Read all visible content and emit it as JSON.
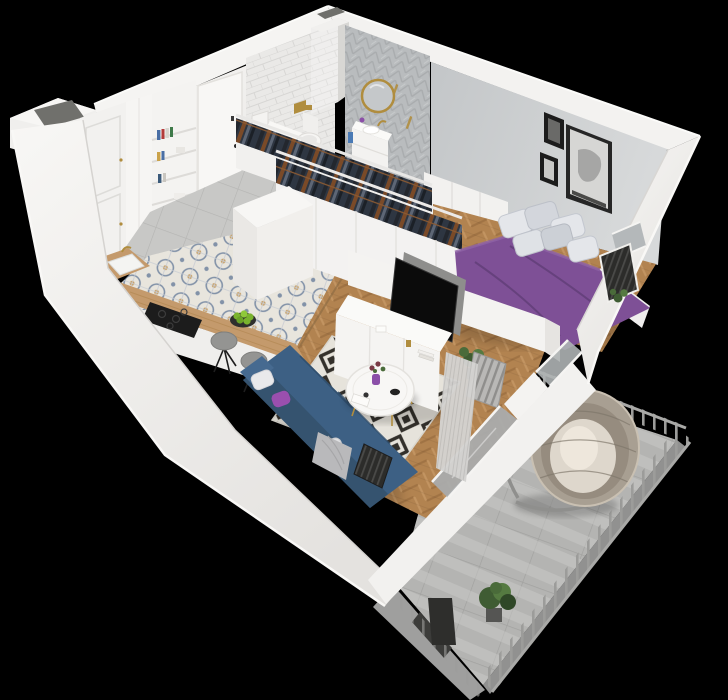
{
  "scene": {
    "type": "3d-apartment-floorplan-render",
    "view": "isometric dollhouse cutaway",
    "background": "#000000"
  },
  "rooms": {
    "kitchen": {
      "label": "kitchen",
      "items": [
        "tall white cabinets",
        "open bookshelf with books",
        "wood countertop",
        "white sink with gold faucet",
        "black cooktop",
        "plate of green apples",
        "two grey bar stools",
        "patterned cement tile floor"
      ]
    },
    "entry": {
      "label": "entry hall",
      "items": [
        "white entry door",
        "grey tile floor",
        "utility shaft"
      ]
    },
    "bathroom": {
      "label": "bathroom",
      "items": [
        "white subway tile wall",
        "grey chevron tile wall",
        "round gold mirror",
        "white vanity with sink",
        "toilet with gold flush plate",
        "washing machine",
        "tiled pillar"
      ]
    },
    "closet": {
      "label": "walk-through closet",
      "items": [
        "two rows of white wardrobes",
        "hanging dark clothes on wooden hangers",
        "white panelled wardrobe front"
      ]
    },
    "bedroom": {
      "label": "bedroom",
      "items": [
        "double bed with purple bedding",
        "white and grey pillows",
        "large framed portrait art",
        "two small black frames",
        "grey feature wall",
        "window with dark radiator",
        "herringbone wood floor"
      ]
    },
    "living_room": {
      "label": "living room",
      "items": [
        "navy corner sofa",
        "white and purple cushions",
        "grey throw blanket",
        "black-and-white diamond rug",
        "white round coffee table with gold legs",
        "purple vase with flowers",
        "white TV sideboard",
        "flat screen TV",
        "grey curtain",
        "radiators",
        "potted plants"
      ]
    },
    "balcony": {
      "label": "balcony",
      "items": [
        "grey metal railing with vertical balusters",
        "hanging rattan egg chair with cushion",
        "concrete tile floor with railing shadows",
        "potted plants",
        "glass balustrade",
        "sliding glass door"
      ]
    }
  },
  "colors": {
    "background": "#000000",
    "wall_white": "#f2f1ef",
    "wall_bright": "#fafaf8",
    "wall_shade": "#dfddda",
    "bedroom_wall": "#c9cccd",
    "subway_tile": "#eae9e7",
    "chevron_tile": "#b9bcbe",
    "entry_tile": "#c8c8c6",
    "bath_floor": "#cdcdcb",
    "pattern_tile_bg": "#e8e5dd",
    "pattern_tile_motif": "#8292a8",
    "pattern_tile_accent": "#c8a26a",
    "wood_floor": "#b28350",
    "counter_wood": "#c49a6c",
    "counter_base": "#efeeec",
    "cooktop_black": "#1c1c1c",
    "plate_dark": "#2f2f2d",
    "apple_green": "#7ab32e",
    "stool_gray": "#949492",
    "island_white": "#f7f6f4",
    "door_white": "#f8f7f5",
    "shaft_dark": "#70706c",
    "clothes_navy": "#2e3642",
    "clothes_black": "#23272e",
    "clothes_brown": "#7a4a28",
    "clothes_gray": "#5d6675",
    "hanger_wood": "#8a5a33",
    "closet_white": "#f3f2f1",
    "bed_purple": "#7e5096",
    "bed_purple_dark": "#5c3a72",
    "bed_pillow": "#e4e6ea",
    "bed_pillow_shade": "#d3d6dc",
    "frame_dark": "#262626",
    "art_paper": "#d6d6d4",
    "halfwall_white": "#f4f3f1",
    "console_white": "#f5f4f2",
    "tv_black": "#0b0b0b",
    "tv_back": "#8e8e8c",
    "rug_light": "#e6e3db",
    "rug_dark": "#33302b",
    "table_white": "#f8f7f5",
    "gold": "#b08d3e",
    "vase_purple": "#8b4fa8",
    "flower_red": "#7a3b46",
    "leaf_green": "#4a6b3a",
    "sofa_blue": "#3d6084",
    "sofa_blue_dark": "#35536f",
    "pillow_white": "#e9e9eb",
    "pillow_purple": "#9a4fae",
    "blanket_gray": "#b9b9bb",
    "radiator_dark": "#2c2c2a",
    "radiator_gray": "#b9b8b6",
    "curtain": "#d4d3d1",
    "glass": "#a9adaf",
    "mirror_glass": "#c5c8ca",
    "towel_blue": "#4a7ab5",
    "balcony_floor": "#b4b4b2",
    "balcony_stripe": "#c9c9c7",
    "railing": "#9c9c9a",
    "chair_rattan": "#a89f92",
    "chair_cushion": "#ded7cc",
    "plant_green": "#3f5c33",
    "plant_green_light": "#557a41"
  }
}
